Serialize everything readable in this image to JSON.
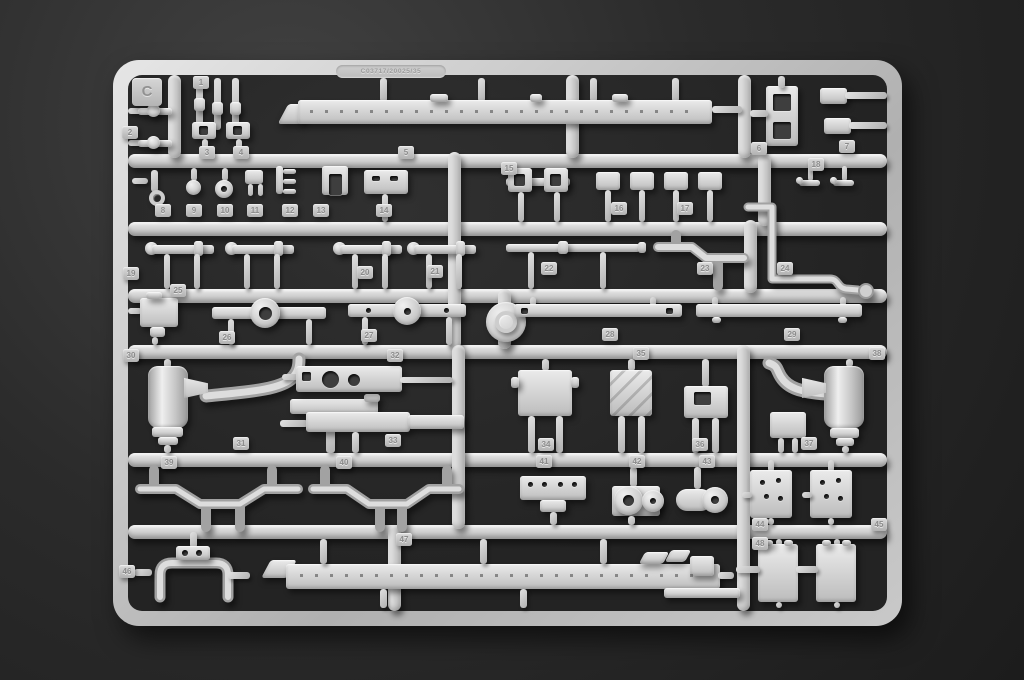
{
  "sprue": {
    "letter": "C",
    "mold_code": "C03717/20025/35",
    "part_numbers": [
      "1",
      "2",
      "3",
      "4",
      "5",
      "6",
      "7",
      "8",
      "9",
      "10",
      "11",
      "12",
      "13",
      "14",
      "15",
      "16",
      "17",
      "18",
      "19",
      "20",
      "21",
      "22",
      "23",
      "24",
      "25",
      "26",
      "27",
      "28",
      "29",
      "30",
      "31",
      "32",
      "33",
      "34",
      "35",
      "36",
      "37",
      "38",
      "39",
      "40",
      "41",
      "42",
      "43",
      "44",
      "45",
      "46",
      "47",
      "48"
    ],
    "colors": {
      "plastic": "#cfcfcf",
      "background": "#232323",
      "tag_text": "#8b8b8b"
    }
  }
}
